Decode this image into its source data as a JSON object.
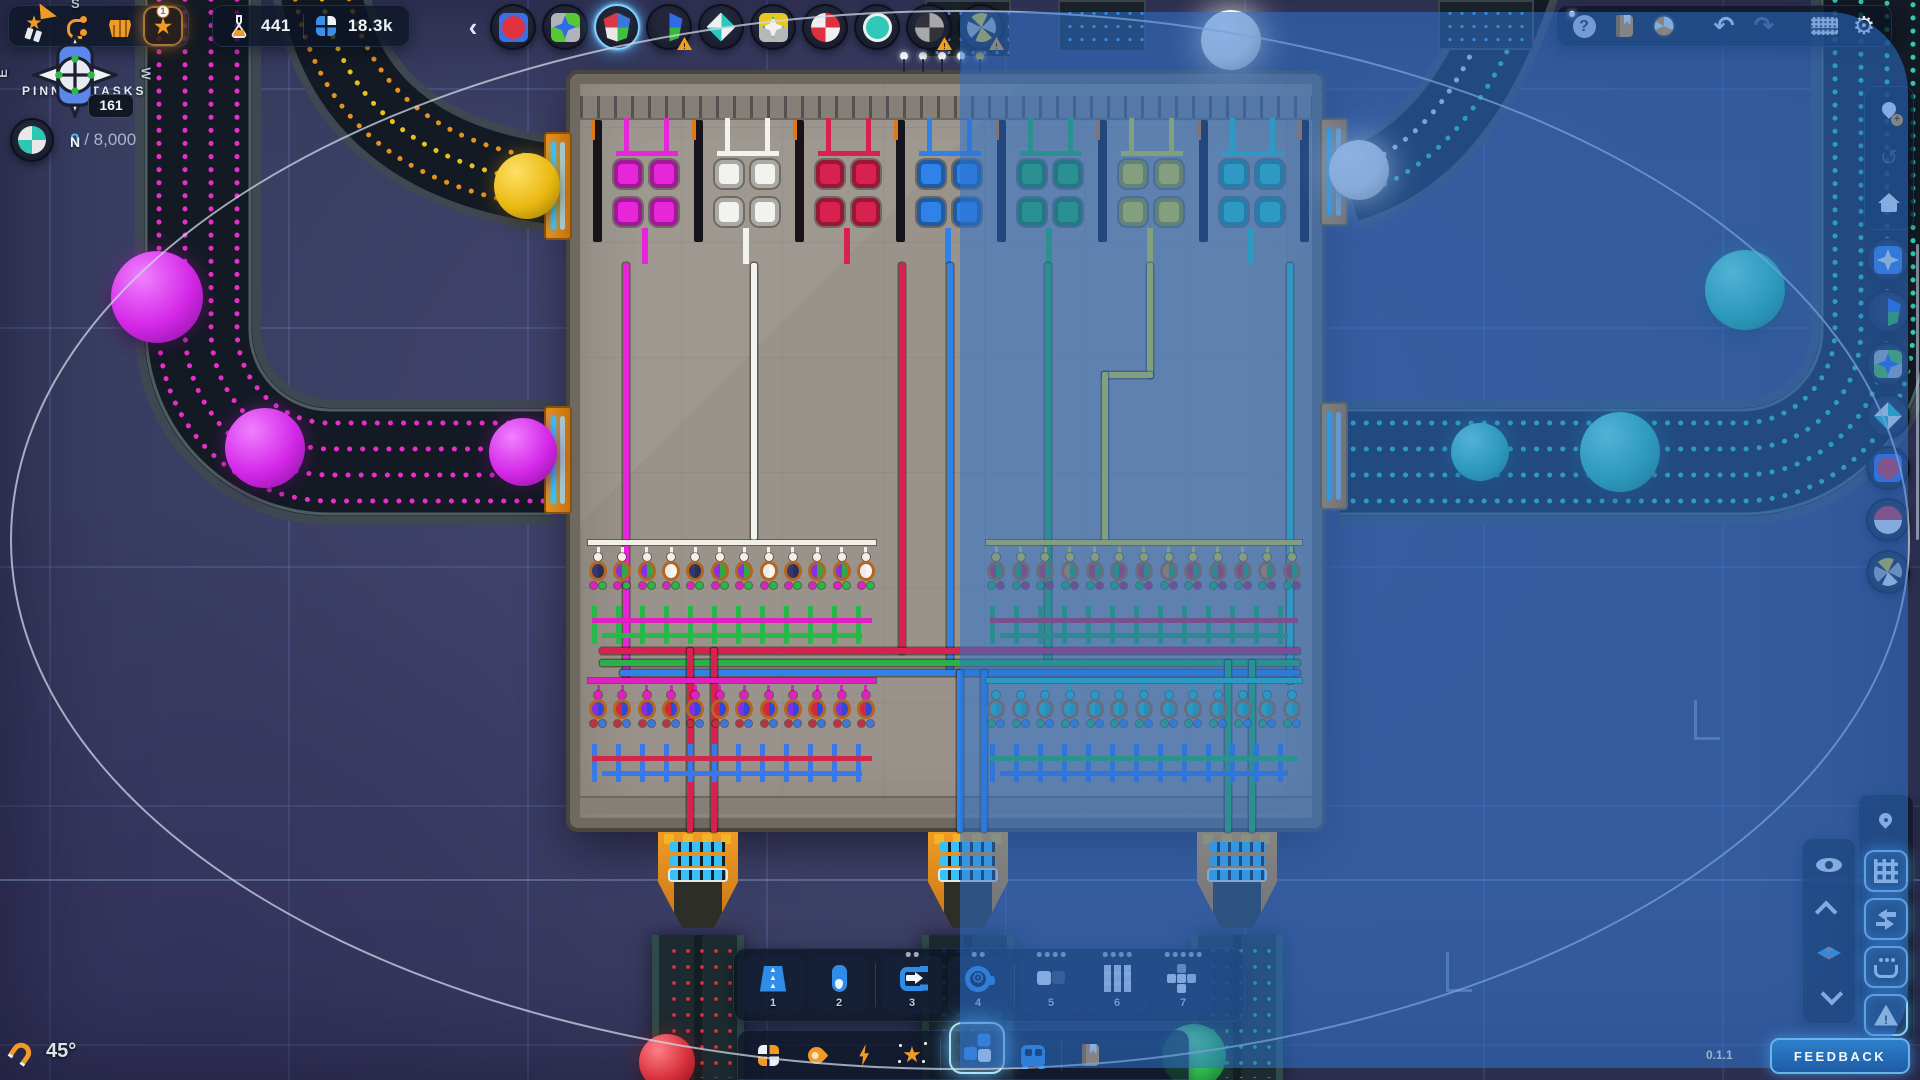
{
  "colors": {
    "accent": "#4fb3f0",
    "orange": "#f09a28",
    "text": "#e8eef6",
    "dim": "#a8b6c8",
    "panel": "rgba(12,20,36,0.78)",
    "glow": "#7fd4ff",
    "blue-btn": "#2f8ce8"
  },
  "top_left": {
    "buttons": [
      {
        "name": "milestones",
        "icon": "medal",
        "glyph": "★"
      },
      {
        "name": "research-tree",
        "icon": "tree"
      },
      {
        "name": "upgrades-shop",
        "icon": "basket"
      },
      {
        "name": "level",
        "icon": "star",
        "glyph": "★",
        "badge": "1",
        "highlighted": true
      }
    ]
  },
  "resources": {
    "science": "441",
    "shapes": "18.3k"
  },
  "shape_toolbar": {
    "collapse_label": "‹",
    "items": [
      {
        "name": "shape-pin-1",
        "type": "circle",
        "base": "#3b6fe8",
        "quad": [
          "#e0333f",
          "#e0333f",
          "#e0333f",
          "#e0333f"
        ]
      },
      {
        "name": "shape-pin-2",
        "type": "star",
        "base_quad": [
          "#58c832",
          "#b0b4b8",
          "#58c832",
          "#b0b4b8"
        ],
        "quad": [
          "#2e6ce8",
          "#2e6ce8",
          "#2e6ce8",
          "#2e6ce8"
        ]
      },
      {
        "name": "shape-pin-3",
        "type": "shield",
        "quad": [
          "#3878d8",
          "#40c040",
          "#e8e8e8",
          "#d83848"
        ],
        "selected": true
      },
      {
        "name": "shape-pin-4",
        "type": "shield",
        "quad": [
          "#2e6ce8",
          "#38b838",
          "#23263a",
          "#23263a"
        ],
        "warning": true
      },
      {
        "name": "shape-pin-5",
        "type": "diamond",
        "quad": [
          "#2cc8c0",
          "#f0f0f0",
          "#2cc8c0",
          "#f0f0f0"
        ]
      },
      {
        "name": "shape-pin-6",
        "type": "star",
        "base_quad": [
          "#e8c820",
          "#b8b8b8",
          "#b8b8b8",
          "#e8c820"
        ],
        "quad": [
          "#f0f0f0",
          "#f0f0f0",
          "#f0f0f0",
          "#f0f0f0"
        ],
        "ring": "#30c050"
      },
      {
        "name": "shape-pin-7",
        "type": "circle",
        "quad": [
          "#e03040",
          "#f0f0f0",
          "#e03040",
          "#f0f0f0"
        ]
      },
      {
        "name": "shape-pin-8",
        "type": "circle",
        "quad": [
          "#30c8b8",
          "#30c8b8",
          "#30c8b8",
          "#30c8b8"
        ],
        "ring": "#f0f0f0"
      },
      {
        "name": "shape-pin-9",
        "type": "circle",
        "quad": [
          "#a8a8a8",
          "#32323a",
          "#a8a8a8",
          "#32323a"
        ],
        "warning": true
      },
      {
        "name": "shape-pin-10",
        "type": "pinwheel",
        "quad": [
          "#e8c820",
          "#b0b0b0",
          "#e8c820",
          "#b0b0b0"
        ],
        "warning": true
      }
    ]
  },
  "pinned_tasks": {
    "title": "PINNED TASKS",
    "task_current": "0",
    "task_sep": "/",
    "task_goal": "8,000",
    "task_shape": {
      "type": "circle",
      "quad": [
        "#2cc8b4",
        "#e8e8e8",
        "#2cc8b4",
        "#e8e8e8"
      ]
    }
  },
  "right_shapes": [
    {
      "name": "goal-shape-1",
      "type": "star",
      "base_quad": [
        "#3b82e8",
        "#3b82e8",
        "#3b82e8",
        "#3b82e8"
      ],
      "quad": [
        "#f0f0f0",
        "#f0f0f0",
        "#f0f0f0",
        "#f0f0f0"
      ]
    },
    {
      "name": "goal-shape-2",
      "type": "shield",
      "quad": [
        "#2e6ce8",
        "#38b838",
        "#23263a",
        "#23263a"
      ]
    },
    {
      "name": "goal-shape-3",
      "type": "star",
      "base_quad": [
        "#58c832",
        "#b0b4b8",
        "#58c832",
        "#b0b4b8"
      ],
      "quad": [
        "#2e6ce8",
        "#2e6ce8",
        "#2e6ce8",
        "#2e6ce8"
      ]
    },
    {
      "name": "goal-shape-4",
      "type": "diamond",
      "quad": [
        "#2cc8c0",
        "#f0f0f0",
        "#2cc8c0",
        "#f0f0f0"
      ]
    },
    {
      "name": "goal-shape-5",
      "type": "circle",
      "base": "#3b6fe8",
      "quad": [
        "#e0333f",
        "#e0333f",
        "#e0333f",
        "#e0333f"
      ]
    },
    {
      "name": "goal-shape-6",
      "type": "circle",
      "quad": [
        "#e03040",
        "#f0f0f0",
        "#f0f0f0",
        "#e03040"
      ]
    },
    {
      "name": "goal-shape-7",
      "type": "pinwheel",
      "quad": [
        "#e8c820",
        "#b0b0b0",
        "#f0f0f0",
        "#b0b0b0"
      ]
    }
  ],
  "hotbar": {
    "slots": [
      {
        "number": "1",
        "icon": "belt",
        "dots": 0
      },
      {
        "number": "2",
        "icon": "pipe",
        "dots": 0
      },
      {
        "number": "3",
        "icon": "extract",
        "dots": 2
      },
      {
        "number": "4",
        "icon": "gearw",
        "dots": 2
      },
      {
        "number": "5",
        "icon": "2sq",
        "dots": 4
      },
      {
        "number": "6",
        "icon": "9grid",
        "dots": 4
      },
      {
        "number": "7",
        "icon": "plus",
        "dots": 5
      }
    ]
  },
  "compass": {
    "n": "N",
    "s": "S",
    "e": "E",
    "w": "W",
    "heading": "161",
    "angle": "45°"
  },
  "feedback": {
    "label": "FEEDBACK",
    "version": "0.1.1"
  },
  "scene": {
    "paint_colors": [
      "#e626d8",
      "#f2f2ee",
      "#d8214e",
      "#2e82e8",
      "#27b34a",
      "#e8d71e",
      "#2fc8b5"
    ],
    "pipes": [
      {
        "x": 623,
        "y": 263,
        "w": 6,
        "h": 415,
        "c": 0
      },
      {
        "x": 751,
        "y": 263,
        "w": 6,
        "h": 277,
        "c": 1
      },
      {
        "x": 899,
        "y": 263,
        "w": 6,
        "h": 391,
        "c": 2
      },
      {
        "x": 947,
        "y": 263,
        "w": 6,
        "h": 407,
        "c": 3
      },
      {
        "x": 1045,
        "y": 263,
        "w": 6,
        "h": 399,
        "c": 4
      },
      {
        "x": 1147,
        "y": 263,
        "w": 6,
        "h": 115,
        "c": 5
      },
      {
        "x": 1102,
        "y": 372,
        "w": 51,
        "h": 6,
        "c": 5
      },
      {
        "x": 1102,
        "y": 372,
        "w": 6,
        "h": 172,
        "c": 5
      },
      {
        "x": 1287,
        "y": 263,
        "w": 6,
        "h": 421,
        "c": 6
      },
      {
        "x": 600,
        "y": 648,
        "w": 700,
        "h": 6,
        "c": 2
      },
      {
        "x": 600,
        "y": 660,
        "w": 700,
        "h": 6,
        "c": 4
      },
      {
        "x": 620,
        "y": 670,
        "w": 680,
        "h": 6,
        "c": 3
      },
      {
        "x": 687,
        "y": 648,
        "w": 6,
        "h": 184,
        "c": 2
      },
      {
        "x": 711,
        "y": 648,
        "w": 6,
        "h": 184,
        "c": 2
      },
      {
        "x": 957,
        "y": 670,
        "w": 6,
        "h": 162,
        "c": 3
      },
      {
        "x": 981,
        "y": 670,
        "w": 6,
        "h": 162,
        "c": 3
      },
      {
        "x": 1225,
        "y": 660,
        "w": 6,
        "h": 172,
        "c": 4
      },
      {
        "x": 1249,
        "y": 660,
        "w": 6,
        "h": 172,
        "c": 4
      }
    ],
    "banks": [
      {
        "x": 588,
        "y": 540,
        "w": 288,
        "units": 12,
        "top": "#f0efe8",
        "bodies": [
          [
            "#34386e",
            "#2a2f58"
          ],
          [
            "#8a30e0",
            "#30a848"
          ],
          [
            "#8a30e0",
            "#30a848"
          ],
          [
            "#ececec",
            "#f6f6f6"
          ]
        ],
        "dots": [
          "#e020c0",
          "#28b848"
        ],
        "pipeA": "#e020c0",
        "pipeB": "#28b848"
      },
      {
        "x": 986,
        "y": 540,
        "w": 316,
        "units": 13,
        "top": "#e8d020",
        "bodies": [
          [
            "#d03040",
            "#28a848"
          ],
          [
            "#28a848",
            "#d03040"
          ],
          [
            "#d03040",
            "#28a848"
          ],
          [
            "#e08828",
            "#28a848"
          ]
        ],
        "dots": [
          "#28b848",
          "#c02848"
        ],
        "pipeA": "#d02840",
        "pipeB": "#28a848"
      },
      {
        "x": 588,
        "y": 678,
        "w": 288,
        "units": 12,
        "top": "#e020c0",
        "bodies": [
          [
            "#8030e0",
            "#3048d8"
          ],
          [
            "#d02840",
            "#3048d8"
          ]
        ],
        "dots": [
          "#c03040",
          "#3878e8"
        ],
        "pipeA": "#d02848",
        "pipeB": "#3878e8"
      },
      {
        "x": 986,
        "y": 678,
        "w": 316,
        "units": 13,
        "top": "#2cc8b4",
        "bodies": [
          [
            "#2cc8b4",
            "#24b0a0"
          ]
        ],
        "dots": [
          "#28c050",
          "#3888e8"
        ],
        "pipeA": "#28b848",
        "pipeB": "#3878e8"
      }
    ],
    "exits": [
      {
        "x": 698,
        "color": "#e23040"
      },
      {
        "x": 968,
        "color": "#3056e8"
      },
      {
        "x": 1237,
        "color": "#2ec850"
      }
    ],
    "balls": [
      {
        "x": 157,
        "y": 297,
        "r": 46,
        "c": "purple"
      },
      {
        "x": 265,
        "y": 448,
        "r": 40,
        "c": "purple"
      },
      {
        "x": 523,
        "y": 452,
        "r": 34,
        "c": "purple"
      },
      {
        "x": 527,
        "y": 186,
        "r": 33,
        "c": "yellow"
      },
      {
        "x": 1359,
        "y": 170,
        "r": 30,
        "c": "white"
      },
      {
        "x": 1231,
        "y": 40,
        "r": 30,
        "c": "white"
      },
      {
        "x": 1480,
        "y": 452,
        "r": 29,
        "c": "teal"
      },
      {
        "x": 1620,
        "y": 452,
        "r": 40,
        "c": "teal"
      },
      {
        "x": 1745,
        "y": 290,
        "r": 40,
        "c": "teal"
      },
      {
        "x": 667,
        "y": 1062,
        "r": 28,
        "c": "red"
      },
      {
        "x": 1194,
        "y": 1056,
        "r": 32,
        "c": "green"
      }
    ],
    "ball_styles": {
      "purple": [
        "#f080ff",
        "#d428e8",
        "#8a12a0"
      ],
      "yellow": [
        "#ffe066",
        "#eab911",
        "#9a7a08"
      ],
      "teal": [
        "#7fffe0",
        "#2ec9a8",
        "#168868"
      ],
      "white": [
        "#ffffff",
        "#f2efe8",
        "#b8b4a8"
      ],
      "red": [
        "#ff8088",
        "#d62f3a",
        "#8a1220"
      ],
      "green": [
        "#80ff9c",
        "#2fb84e",
        "#147030"
      ]
    }
  }
}
